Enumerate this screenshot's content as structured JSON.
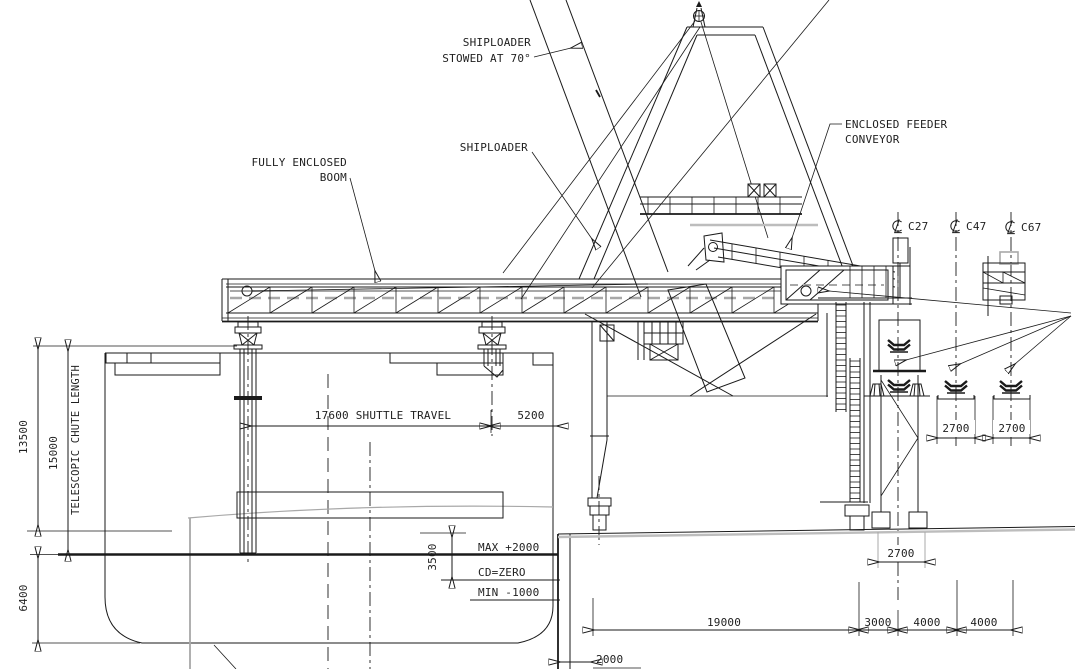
{
  "drawing": {
    "callouts": {
      "stowed_line1": "SHIPLOADER",
      "stowed_line2": "STOWED AT 70°",
      "shiploader": "SHIPLOADER",
      "boom_line1": "FULLY ENCLOSED",
      "boom_line2": "BOOM",
      "feeder_line1": "ENCLOSED FEEDER",
      "feeder_line2": "CONVEYOR"
    },
    "conveyor_lines": {
      "c27": "C27",
      "c47": "C47",
      "c67": "C67"
    },
    "levels": {
      "max": "MAX +2000",
      "cd": "CD=ZERO",
      "min": "MIN -1000"
    },
    "dimensions": {
      "quay_to_deck": "13500",
      "telescopic_value": "15000",
      "telescopic_label": "TELESCOPIC CHUTE LENGTH",
      "draft": "6400",
      "shuttle_travel": "17600 SHUTTLE TRAVEL",
      "boom_end": "5200",
      "tide_range": "3500",
      "quay_span": "19000",
      "rail_to_c27": "3000",
      "c27_to_c47": "4000",
      "c47_to_c67": "4000",
      "quay_edge": "2000",
      "idler_c47": "2700",
      "idler_c67": "2700",
      "tower_base": "2700"
    }
  }
}
